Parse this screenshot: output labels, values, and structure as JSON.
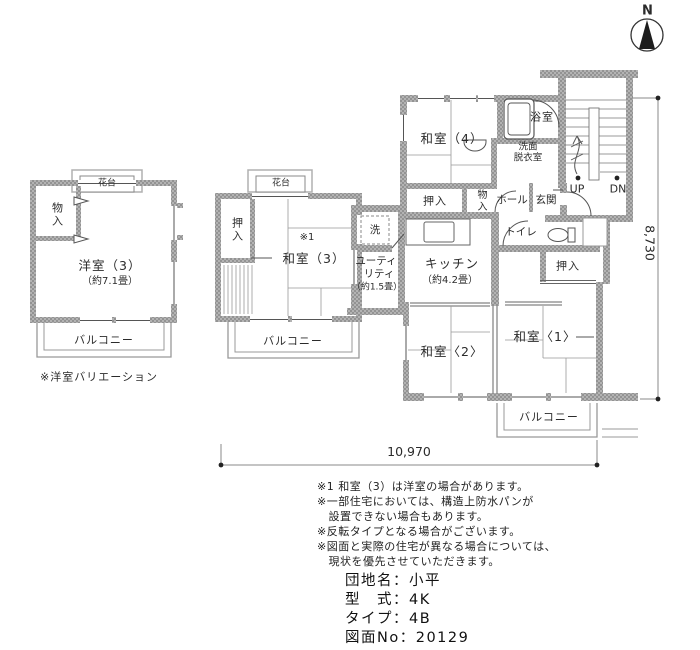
{
  "compass": {
    "north_label": "N"
  },
  "variation_plan": {
    "flower_shelf": "花台",
    "storage": "物入",
    "room_name": "洋室（3）",
    "room_size": "（約7.1畳）",
    "balcony": "バルコニー",
    "caption": "※洋室バリエーション"
  },
  "annex_plan": {
    "flower_shelf": "花台",
    "closet": "押入",
    "footnote_ref": "※1",
    "room_name": "和室（3）",
    "balcony": "バルコニー"
  },
  "main_plan": {
    "japanese_room_4": "和室（4）",
    "bathroom": "浴室",
    "washroom_line1": "洗面",
    "washroom_line2": "脱衣室",
    "closet_top": "押入",
    "storage": "物入",
    "hall": "ホール",
    "entrance": "玄関",
    "stairs_up": "UP",
    "stairs_down": "DN",
    "toilet": "トイレ",
    "washer": "洗",
    "utility_line1": "ユーティ",
    "utility_line2": "リティ",
    "utility_line3": "（約1.5畳）",
    "kitchen": "キッチン",
    "kitchen_size": "（約4.2畳）",
    "closet_right": "押入",
    "japanese_room_1": "和室〈1〉",
    "japanese_room_2": "和室〈2〉",
    "balcony": "バルコニー"
  },
  "dimensions": {
    "vertical": "8,730",
    "horizontal": "10,970"
  },
  "notes": [
    "※1 和室（3）は洋室の場合があります。",
    "※一部住宅においては、構造上防水パンが",
    "　設置できない場合もあります。",
    "※反転タイプとなる場合がございます。",
    "※図面と実際の住宅が異なる場合については、",
    "　現状を優先させていただきます。"
  ],
  "title_block": {
    "estate_label": "団地名：小平",
    "model_label": "型　式：4K",
    "type_label": "タイプ：4B",
    "drawing_no_label": "図面No：20129"
  }
}
